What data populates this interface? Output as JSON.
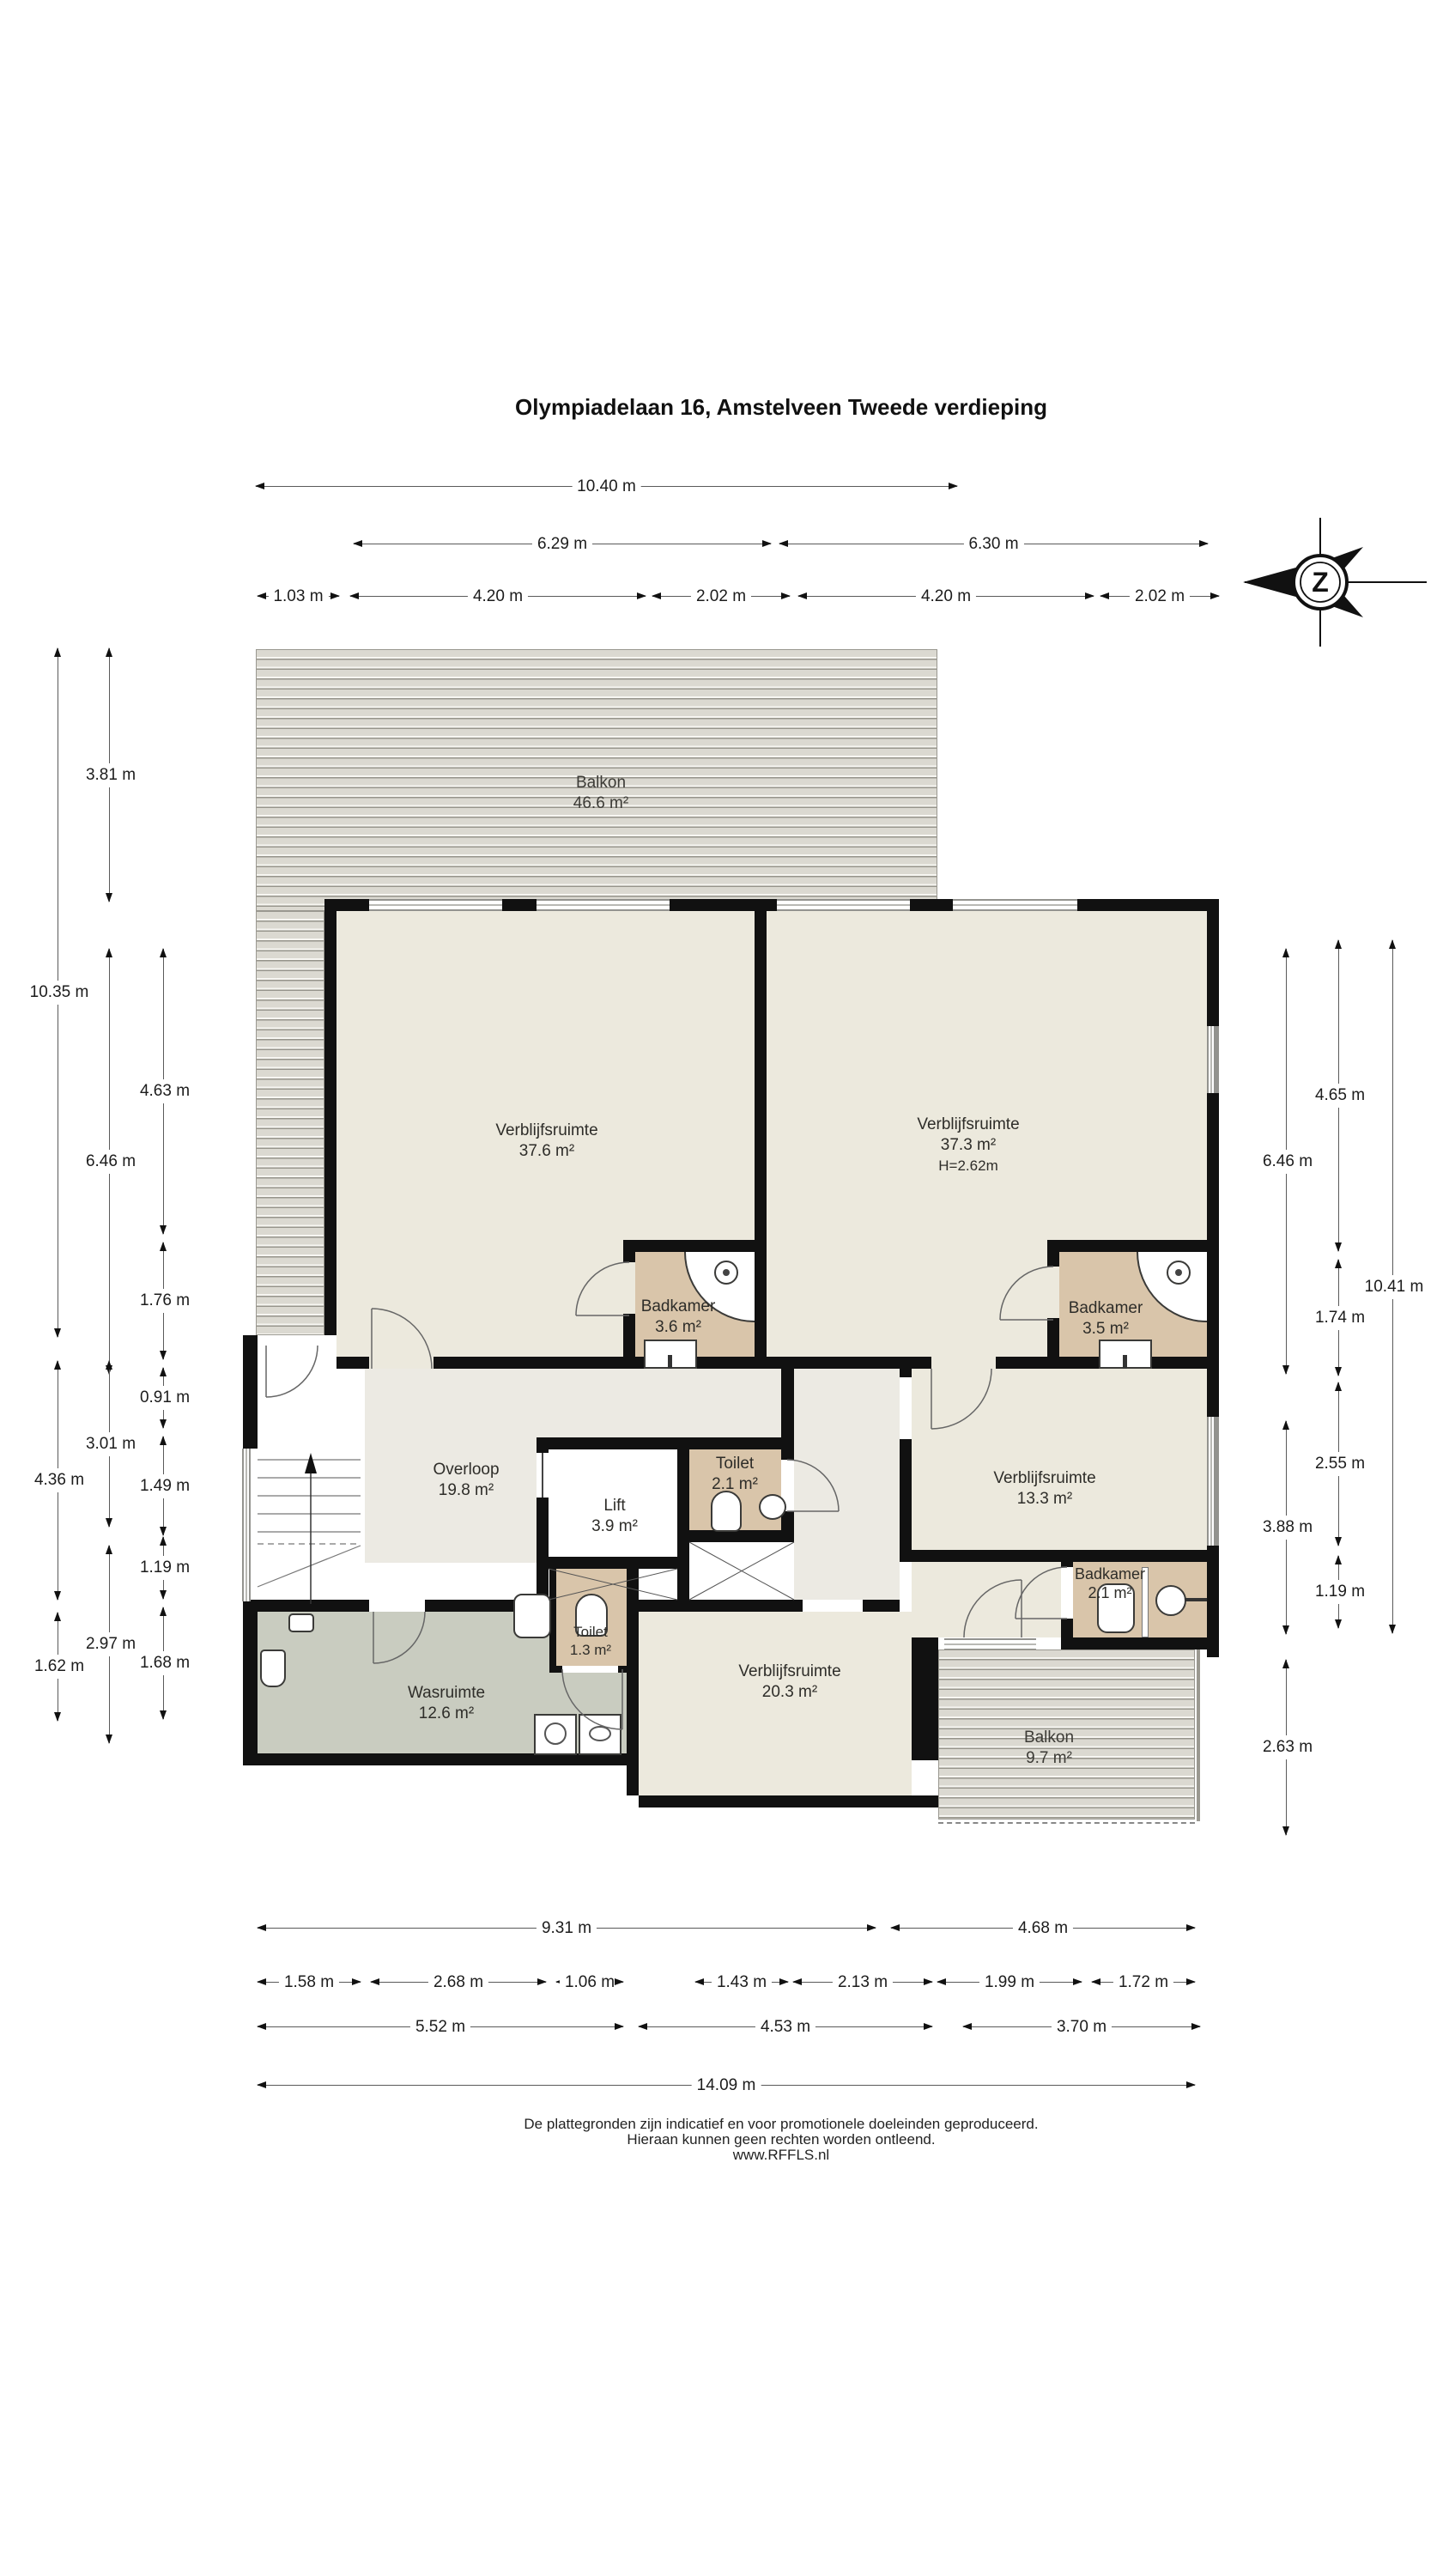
{
  "title": {
    "line1": "Olympiadelaan 16, Amstelveen",
    "line2": "Tweede verdieping"
  },
  "compass": {
    "letter": "Z"
  },
  "rooms": {
    "balkon_top": {
      "name": "Balkon",
      "area": "46.6 m²"
    },
    "verblijfsruimte_37_6": {
      "name": "Verblijfsruimte",
      "area": "37.6 m²"
    },
    "verblijfsruimte_37_3": {
      "name": "Verblijfsruimte",
      "area": "37.3 m²",
      "height": "H=2.62m"
    },
    "badkamer_3_6": {
      "name": "Badkamer",
      "area": "3.6 m²"
    },
    "badkamer_3_5": {
      "name": "Badkamer",
      "area": "3.5 m²"
    },
    "overloop": {
      "name": "Overloop",
      "area": "19.8 m²"
    },
    "lift": {
      "name": "Lift",
      "area": "3.9 m²"
    },
    "toilet_2_1": {
      "name": "Toilet",
      "area": "2.1 m²"
    },
    "verblijfsruimte_13_3": {
      "name": "Verblijfsruimte",
      "area": "13.3 m²"
    },
    "badkamer_2_1": {
      "name": "Badkamer",
      "area": "2.1 m²"
    },
    "toilet_1_3": {
      "name": "Toilet",
      "area": "1.3 m²"
    },
    "wasruimte": {
      "name": "Wasruimte",
      "area": "12.6 m²"
    },
    "verblijfsruimte_20_3": {
      "name": "Verblijfsruimte",
      "area": "20.3 m²"
    },
    "balkon_9_7": {
      "name": "Balkon",
      "area": "9.7 m²"
    }
  },
  "dims": {
    "top": [
      "10.40 m",
      "6.29 m",
      "6.30 m",
      "1.03 m",
      "4.20 m",
      "2.02 m",
      "4.20 m",
      "2.02 m"
    ],
    "bottom": [
      "9.31 m",
      "4.68 m",
      "1.58 m",
      "2.68 m",
      "1.06 m",
      "1.43 m",
      "2.13 m",
      "1.99 m",
      "1.72 m",
      "5.52 m",
      "4.53 m",
      "3.70 m",
      "14.09 m"
    ],
    "left": [
      "3.81 m",
      "10.35 m",
      "4.63 m",
      "6.46 m",
      "1.76 m",
      "0.91 m",
      "3.01 m",
      "1.49 m",
      "4.36 m",
      "1.19 m",
      "2.97 m",
      "1.62 m",
      "1.68 m"
    ],
    "right": [
      "4.65 m",
      "6.46 m",
      "10.41 m",
      "1.74 m",
      "2.55 m",
      "3.88 m",
      "1.19 m",
      "2.63 m"
    ]
  },
  "footer": {
    "line1": "De plattegronden zijn indicatief en voor promotionele doeleinden geproduceerd.",
    "line2": "Hieraan kunnen geen rechten worden ontleend.",
    "line3": "www.RFFLS.nl"
  },
  "colors": {
    "room": "#ECE9DD",
    "bathroom": "#D9C5AA",
    "corridor": "#ECEAE3",
    "utility": "#C9CCC0",
    "deck": "#DBD9D1",
    "wall": "#111111"
  }
}
